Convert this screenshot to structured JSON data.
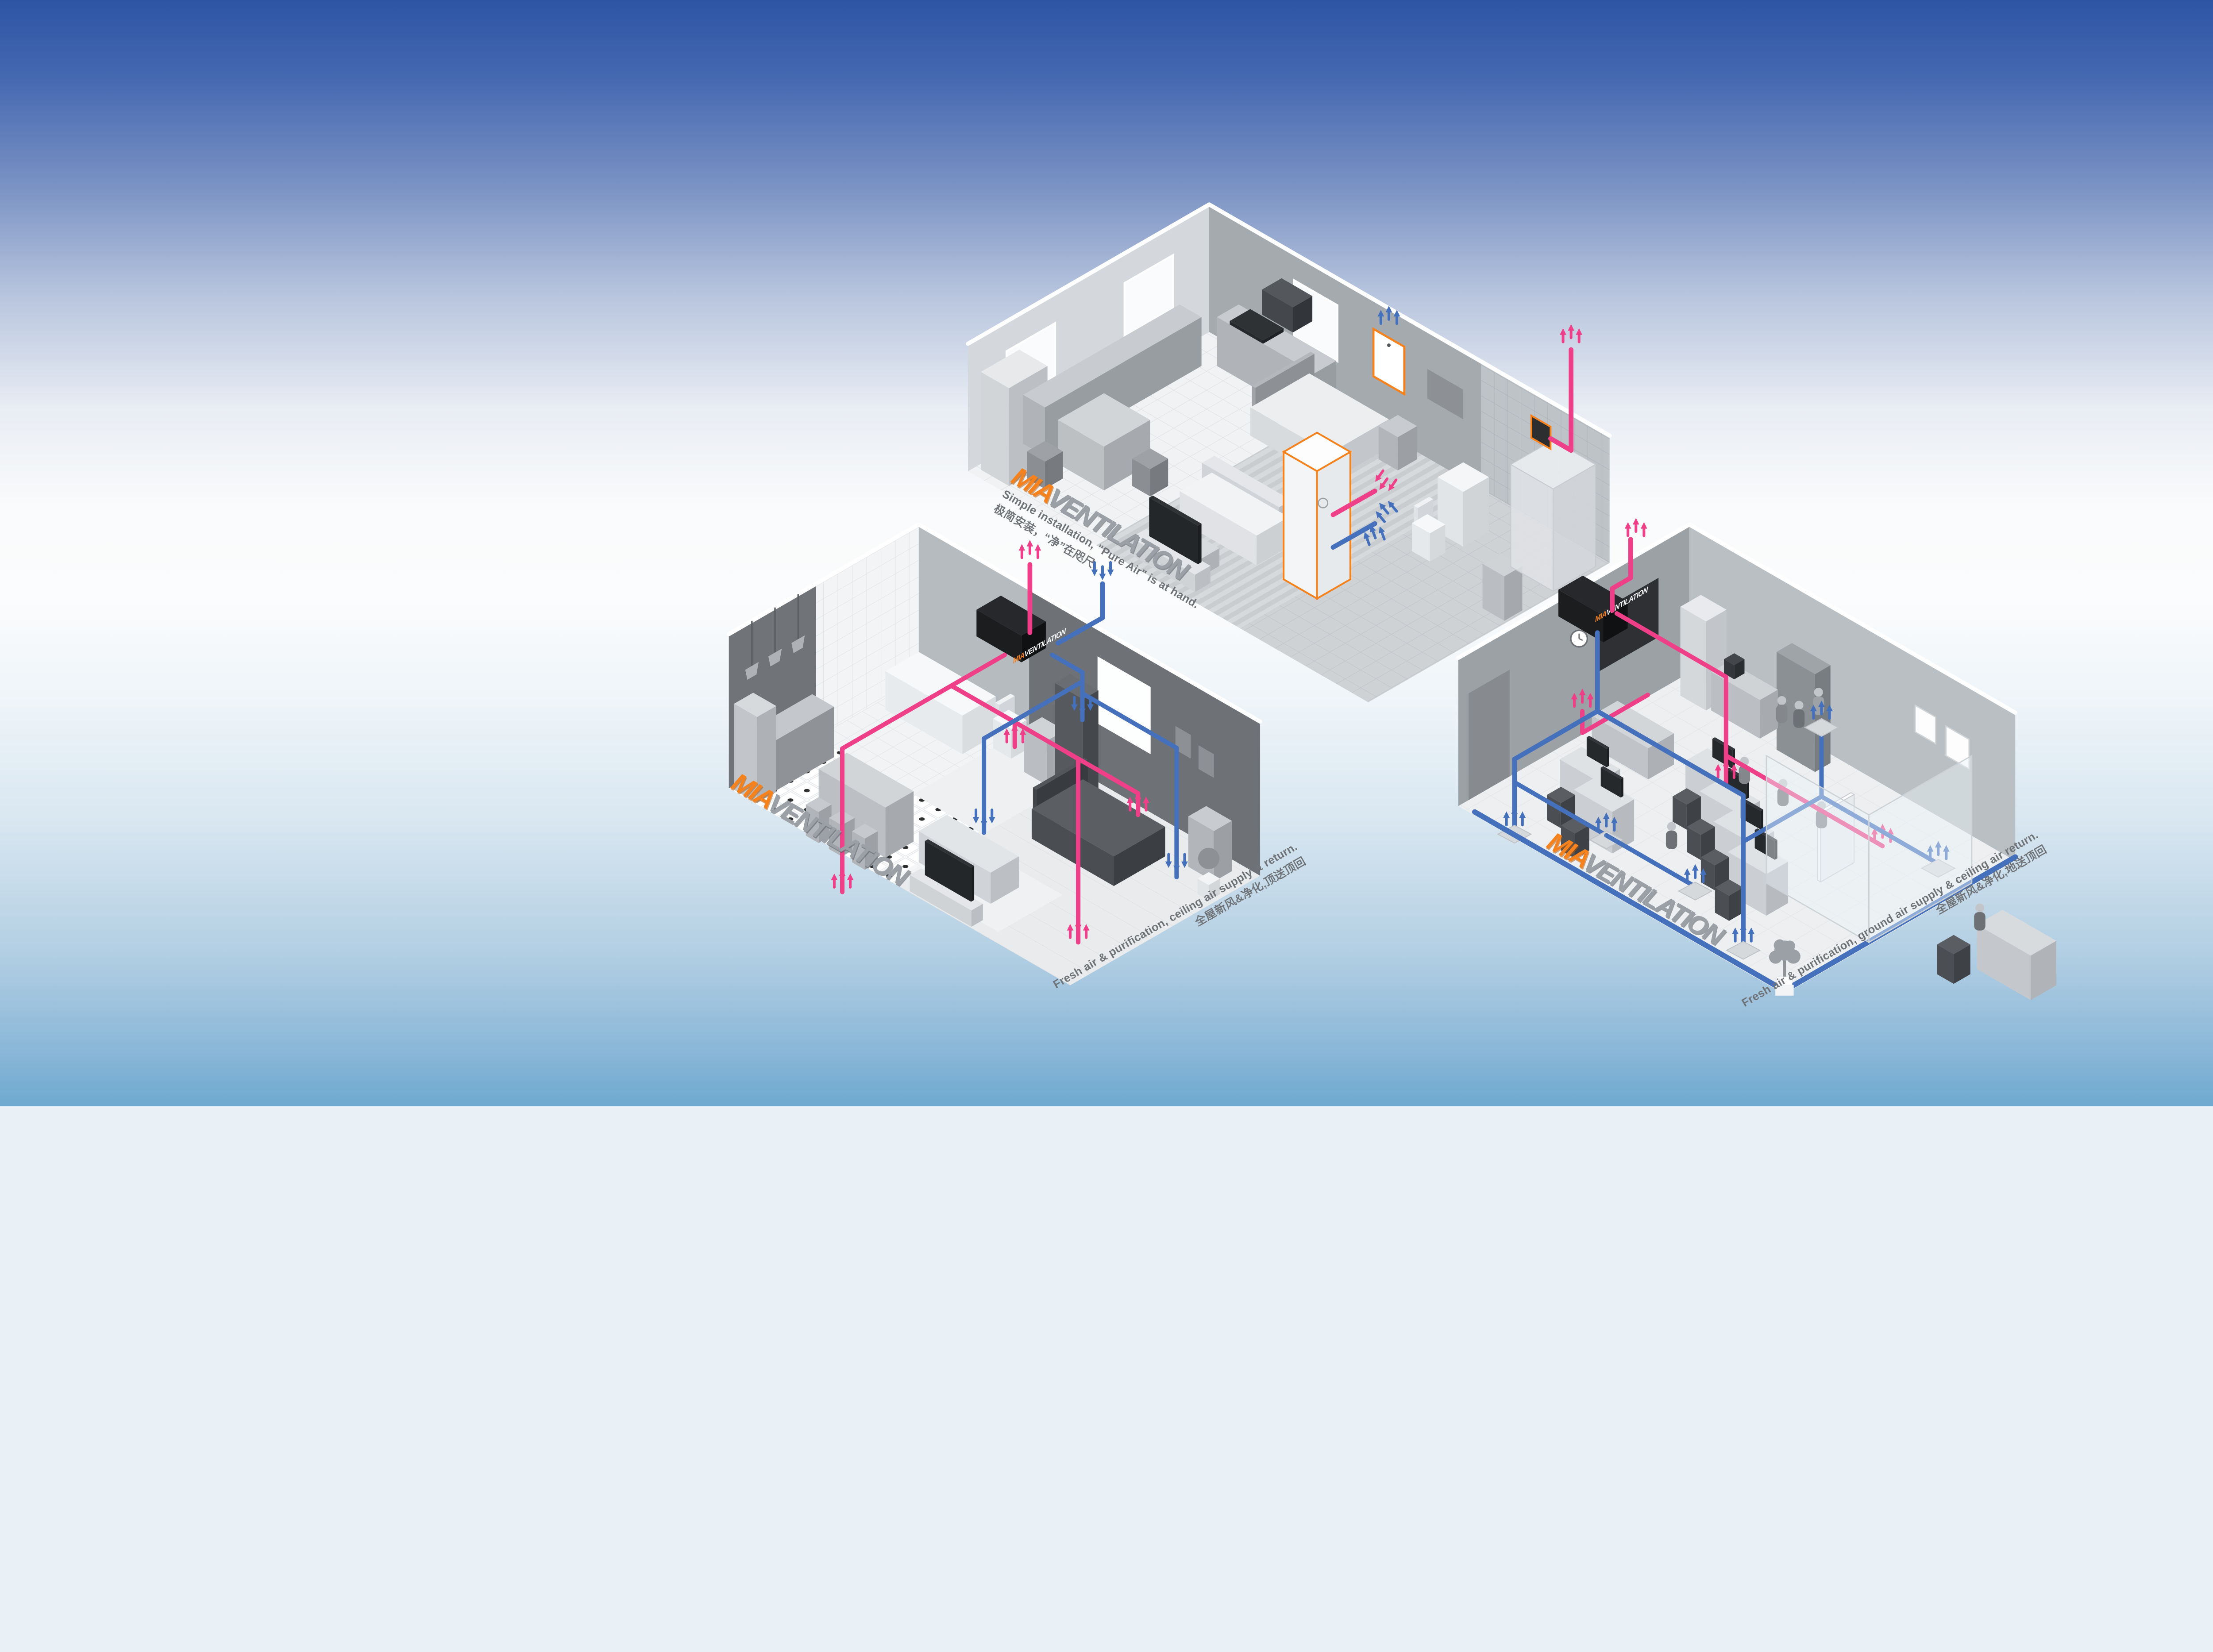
{
  "poster": {
    "background": {
      "style": "vertical gradient, deep blue to white to light blue"
    }
  },
  "brand": {
    "name_prefix": "MIA",
    "name_suffix": "VENTILATION"
  },
  "erv_unit_label": {
    "prefix": "MIA",
    "suffix": "VENTILATION"
  },
  "icons": {
    "supply_arrows": "↑↑↑",
    "return_arrows": "↓↓↓"
  },
  "colors": {
    "bg_top": "#2d55a4",
    "bg_bottom": "#6ea9cf",
    "supply_pink": "#ee3f88",
    "return_blue": "#4470bc",
    "accent_orange": "#f6821e",
    "logo_gray": "#9aa0a6",
    "caption_gray": "#6f7377",
    "wall_light": "#d4d7db",
    "wall_mid": "#a5aaaf",
    "wall_dark": "#6e7277",
    "erv_black": "#1e2023"
  },
  "scenes": [
    {
      "id": "apartment",
      "caption_en": "Simple installation, \"Pure Air\" is at hand.",
      "caption_zh": "极简安装，“净”在咫尺"
    },
    {
      "id": "home-ceiling-supply",
      "caption_en": "Fresh air & purification, ceiling air supply & return.",
      "caption_zh": "全屋新风&净化,顶送顶回"
    },
    {
      "id": "office-ground-supply",
      "caption_en": "Fresh air & purification, ground air supply & ceiling air return.",
      "caption_zh": "全屋新风&净化,地送顶回"
    }
  ]
}
